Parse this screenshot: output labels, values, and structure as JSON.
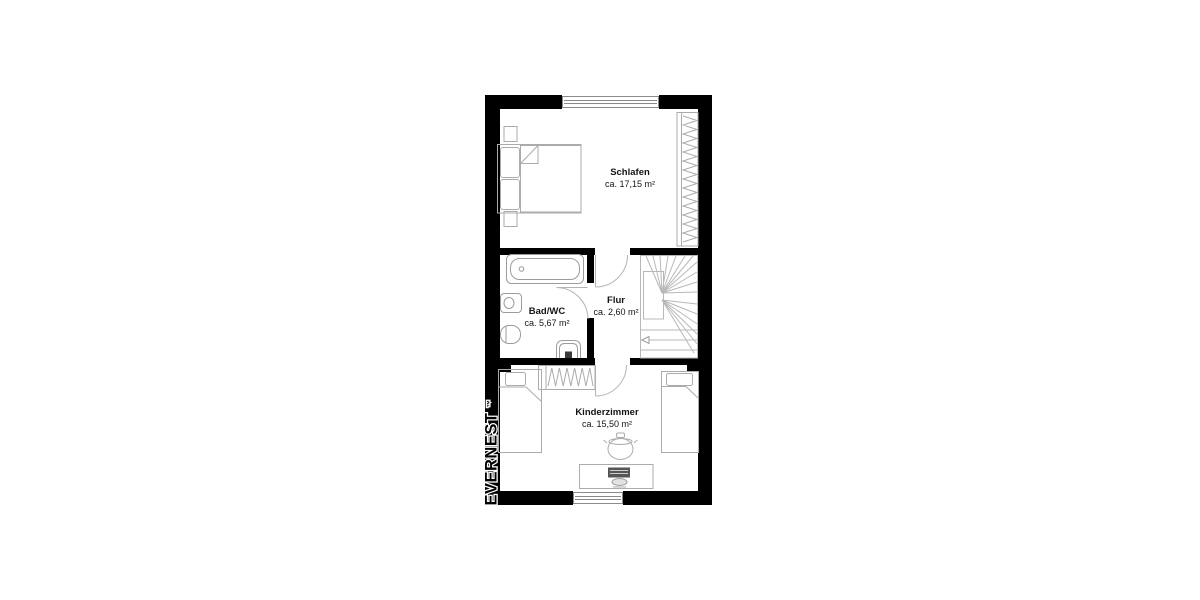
{
  "watermark": {
    "text": "EVERNEST",
    "mark": "™"
  },
  "rooms": [
    {
      "name": "Schlafen",
      "area": "ca. 17,15 m²"
    },
    {
      "name": "Bad/WC",
      "area": "ca. 5,67 m²"
    },
    {
      "name": "Flur",
      "area": "ca. 2,60 m²"
    },
    {
      "name": "Kinderzimmer",
      "area": "ca. 15,50 m²"
    }
  ],
  "colors": {
    "walls": "#000000",
    "furniture_lines": "#ababab",
    "fixture_lines": "#9c9c9c",
    "background": "#ffffff",
    "label_text": "#141414"
  }
}
